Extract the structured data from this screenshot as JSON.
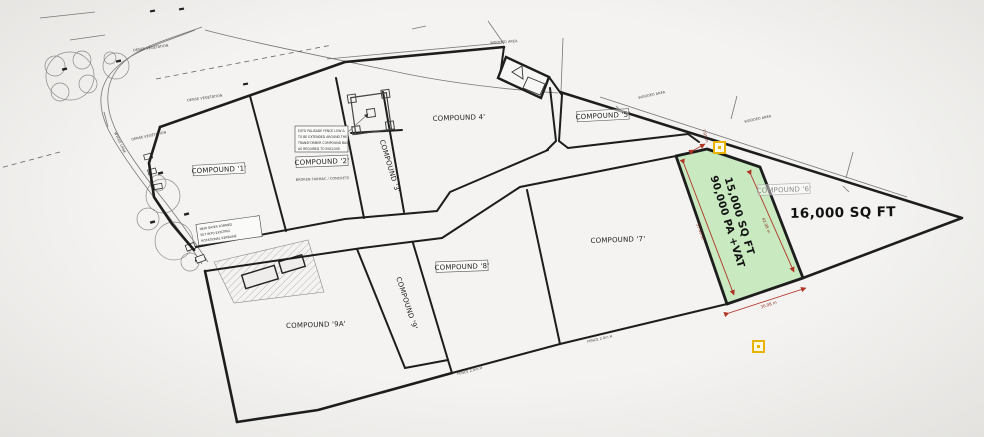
{
  "compounds": {
    "c1": "COMPOUND '1'",
    "c2": "COMPOUND '2'",
    "c3": "COMPOUND '3'",
    "c4": "COMPOUND 4'",
    "c5": "COMPOUND '5'",
    "c6": "COMPOUND '6'",
    "c7": "COMPOUND '7'",
    "c8": "COMPOUND '8'",
    "c9": "COMPOUND '9'",
    "c9a": "COMPOUND '9A'"
  },
  "highlight": {
    "line1": "15,000 SQ FT",
    "line2": "90,000 PA +VAT"
  },
  "plot_right": {
    "label": "16,000 SQ FT"
  },
  "surface_note": "BROKEN TARMAC / CONCRETE",
  "dims": {
    "west": "57.40 m",
    "east": "42.98 m",
    "south": "30.08 m",
    "north": "7.95 m"
  },
  "fence_label": "FENCE 2.0m H",
  "veg": {
    "dense": "DENSE VEGETATION",
    "wooded": "WOODED AREA"
  },
  "road": "WYCKE LANE",
  "notes": {
    "palisade": [
      "EXTG PALISADE FENCE LOW &",
      "TO BE EXTENDED AROUND THE",
      "TRANSFORMER COMPOUND BASE",
      "AS REQUIRED TO ENCLOSE."
    ],
    "gates": [
      "NEW GATES FORMED",
      "SET INTO EXISTING",
      "ROTATIONAL KERBLINE"
    ]
  },
  "colors": {
    "green": "#c9e9c0",
    "dim_red": "#b03325",
    "yellow": "#e8b400",
    "line": "#1d1d1d"
  }
}
